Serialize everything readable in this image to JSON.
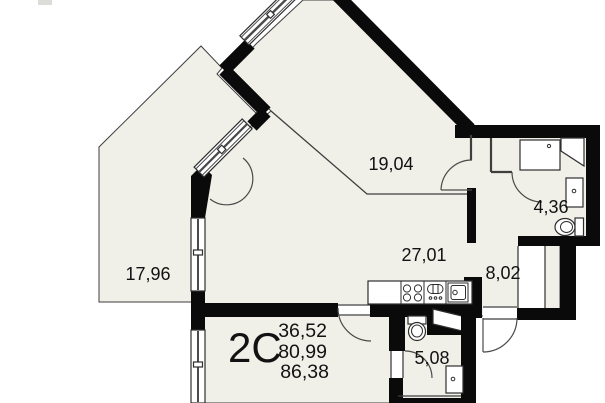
{
  "plan": {
    "unit_label": "2C",
    "areas": {
      "living": "36,52",
      "apartment": "80,99",
      "total": "86,38"
    },
    "rooms": {
      "balcony": "17,96",
      "room": "19,04",
      "kitchen_living": "27,01",
      "hallway": "8,02",
      "bathroom": "4,36",
      "wc": "5,08"
    },
    "colors": {
      "floor": "#f0efe8",
      "wall": "#0a0a0a",
      "line": "#3e3e3e",
      "text": "#121212"
    }
  }
}
